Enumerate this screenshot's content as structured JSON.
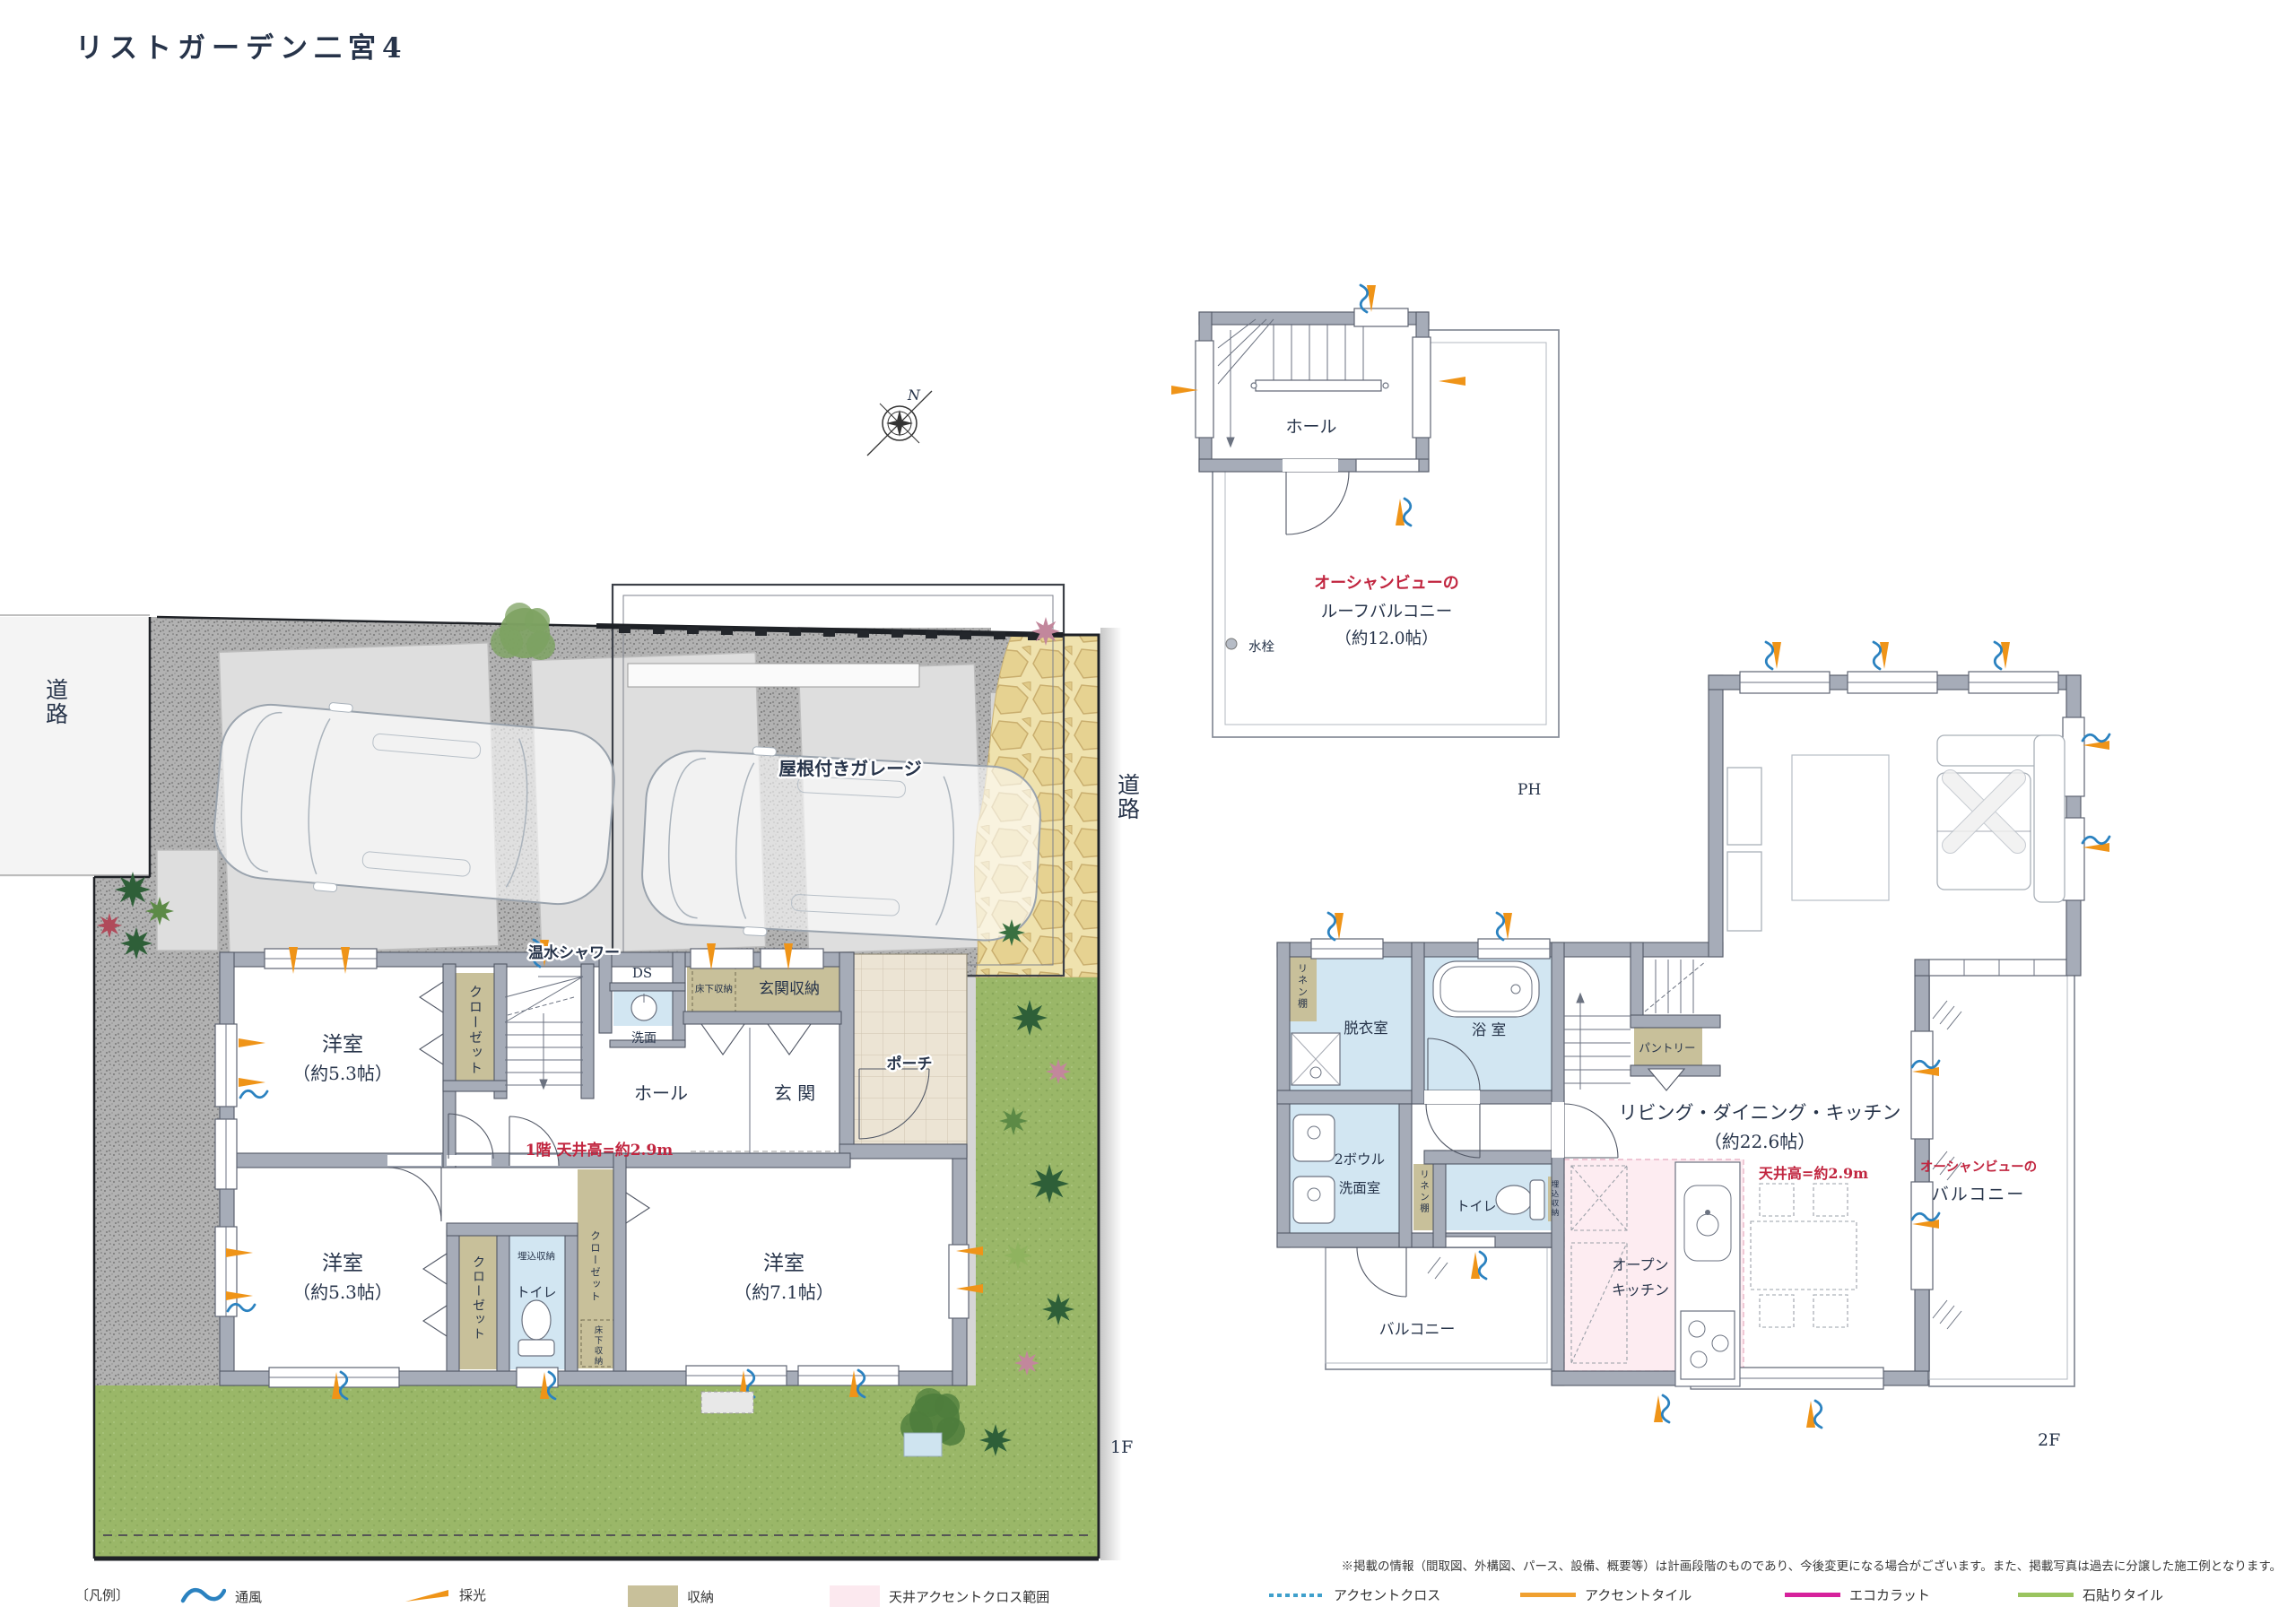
{
  "title": "リストガーデン二宮4",
  "compass": {
    "north": "N"
  },
  "site": {
    "road_left": "道路",
    "road_right": "道路",
    "garage": "屋根付きガレージ",
    "hot_water_shower": "温水シャワー",
    "floor_label": "1F"
  },
  "plan1f": {
    "bed1": {
      "name": "洋室",
      "size": "（約5.3帖）"
    },
    "bed2": {
      "name": "洋室",
      "size": "（約5.3帖）"
    },
    "bed3": {
      "name": "洋室",
      "size": "（約7.1帖）"
    },
    "closet": "クローゼット",
    "hall": "ホール",
    "entrance": "玄 関",
    "porch": "ポーチ",
    "entrance_storage": "玄関収納",
    "underfloor_storage": "床下収納",
    "ds": "DS",
    "washbasin": "洗面",
    "toilet": "トイレ",
    "built_in_storage": "埋込収納",
    "ceiling_note": "1階 天井高=約2.9m"
  },
  "planph": {
    "hall": "ホール",
    "ocean_view_prefix": "オーシャンビューの",
    "roof_balcony": "ルーフバルコニー",
    "roof_balcony_size": "（約12.0帖）",
    "faucet": "水栓",
    "floor_label": "PH"
  },
  "plan2f": {
    "linen_shelf": "リネン棚",
    "dressing_room": "脱衣室",
    "bathroom": "浴 室",
    "pantry": "パントリー",
    "washroom_line1": "2ボウル",
    "washroom_line2": "洗面室",
    "toilet": "トイレ",
    "built_in_storage": "埋込収納",
    "ldk_name": "リビング・ダイニング・キッチン",
    "ldk_size": "（約22.6帖）",
    "ceiling_note": "天井高=約2.9m",
    "open_kitchen_line1": "オープン",
    "open_kitchen_line2": "キッチン",
    "balcony": "バルコニー",
    "ocean_view_prefix": "オーシャンビューの",
    "ocean_balcony": "バルコニー",
    "floor_label": "2F"
  },
  "legend": {
    "heading": "〔凡例〕",
    "items": [
      {
        "label": "通風",
        "type": "wave",
        "color": "#2b82c0"
      },
      {
        "label": "採光",
        "type": "arrow",
        "color": "#ef9418"
      },
      {
        "label": "収納",
        "type": "swatch",
        "color": "#c8c09a"
      },
      {
        "label": "天井アクセントクロス範囲",
        "type": "swatch",
        "color": "#fce9ef"
      },
      {
        "label": "アクセントクロス",
        "type": "dotted",
        "color": "#3fa0cc"
      },
      {
        "label": "アクセントタイル",
        "type": "line",
        "color": "#f0a030"
      },
      {
        "label": "エコカラット",
        "type": "line",
        "color": "#d6219c"
      },
      {
        "label": "石貼りタイル",
        "type": "line",
        "color": "#9ac45f"
      }
    ]
  },
  "disclaimer": "※掲載の情報（間取図、外構図、パース、設備、概要等）は計画段階のものであり、今後変更になる場合がございます。また、掲載写真は過去に分譲した施工例となります。"
}
